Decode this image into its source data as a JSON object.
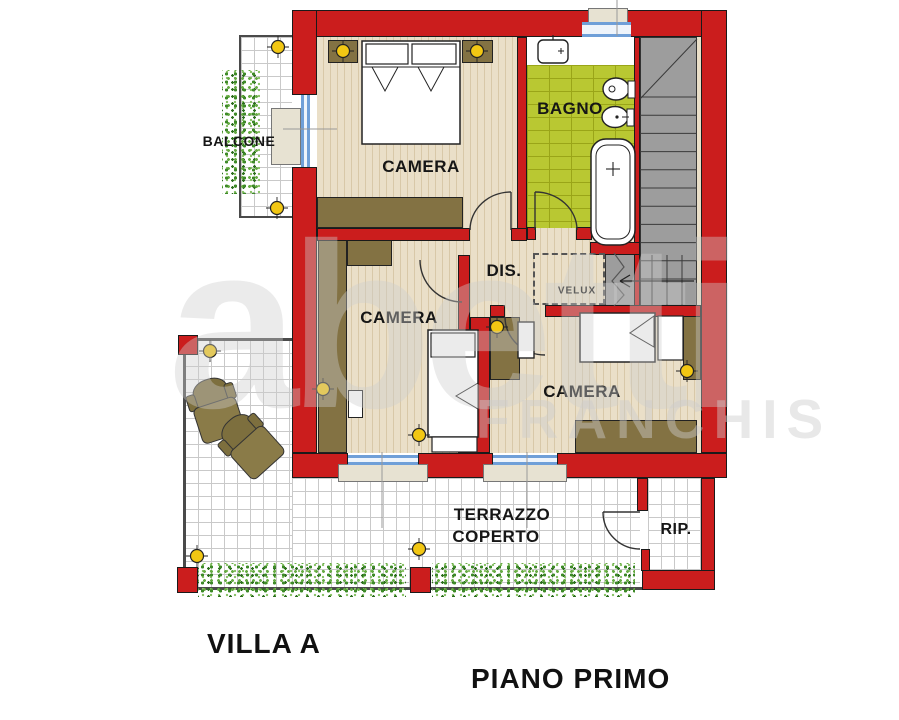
{
  "floorplan": {
    "rooms": {
      "balcone": "BALCONE",
      "camera_top": "CAMERA",
      "bagno": "BAGNO",
      "dis": "DIS.",
      "velux": "VELUX",
      "camera_middle": "CAMERA",
      "camera_bottom": "CAMERA",
      "terrazzo_line1": "TERRAZZO",
      "terrazzo_line2": "COPERTO",
      "rip": "RIP."
    },
    "titles": {
      "unit": "VILLA A",
      "floor": "PIANO PRIMO"
    },
    "watermark": {
      "brand": "abetti",
      "franchise": "FRANCHIS"
    },
    "colors": {
      "wall_red": "#cb1d1d",
      "furniture_olive": "#837243",
      "bagno_green": "#b9c832",
      "stairs_gray": "#9d9d9d",
      "marker_yellow": "#f2c713",
      "window_blue": "#6f9fd8",
      "plant_green": "#4d9433",
      "floor_wood": "#eadfc8",
      "tile_line_gray": "#c9c9c9"
    }
  }
}
